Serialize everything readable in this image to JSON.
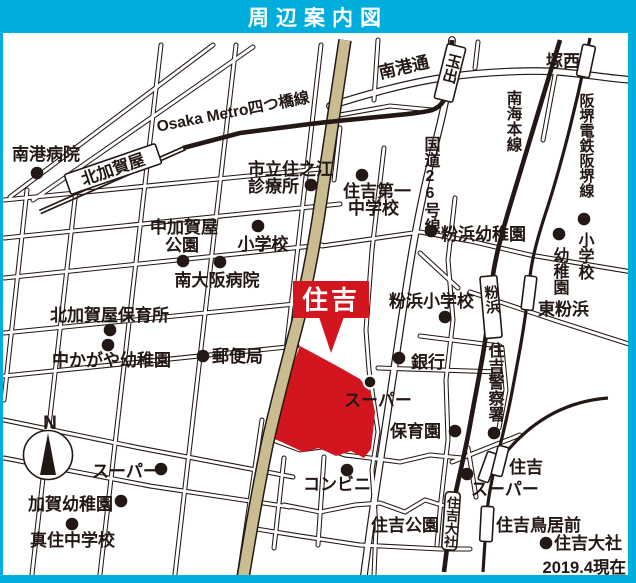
{
  "title": "周辺案内図",
  "note": "2019.4現在",
  "compass_n": "N",
  "callout": "住吉",
  "colors": {
    "accent": "#00aedd",
    "highlight_red": "#d2151e",
    "road_tan": "#c8bc90"
  },
  "places": {
    "nanko_hospital": "南港病院",
    "kitakagaya_station": "北加賀屋",
    "metro_yotsubashi": "Osaka Metro四つ橋線",
    "shiritsu_clinic_1": "市立住之江",
    "shiritsu_clinic_2": "診療所",
    "nakakagaya_park_1": "中加賀屋",
    "nakakagaya_park_2": "公園",
    "elementary_west": "小学校",
    "minamiosaka_hospital": "南大阪病院",
    "kitakagaya_nursery": "北加賀屋保育所",
    "nakakagaya_kindergarten": "中かがや幼稚園",
    "post_office": "郵便局",
    "sumiyoshi_daiichi_1": "住吉第一",
    "sumiyoshi_daiichi_2": "中学校",
    "nankodori": "南港通",
    "tamade_station": "玉出",
    "tsukanishi_station": "塚西",
    "route26": "国道26号線",
    "nankai_line": "南海本線",
    "hankai_line": "阪堺電鉄阪堺線",
    "kohama_kindergarten": "粉浜幼稚園",
    "kohama_elementary": "粉浜小学校",
    "kohama_station": "粉浜",
    "higashi_kohama_station": "東粉浜",
    "elementary_east": "小学校",
    "kindergarten_east": "幼稚園",
    "bank": "銀行",
    "supermarket_center": "スーパー",
    "nursery_center": "保育園",
    "police": "住吉警察署",
    "sumiyoshi_tram_station": "住吉",
    "supermarket_right": "スーパー",
    "convenience_store": "コンビニ",
    "sumiyoshi_park": "住吉公園",
    "toriimae_station": "住吉鳥居前",
    "sumiyoshi_taisha": "住吉大社",
    "sumiyoshi_taisha_station": "住吉大社",
    "supermarket_left": "スーパー",
    "kaga_kindergarten": "加賀幼稚園",
    "masumi_junior_high": "真住中学校"
  }
}
